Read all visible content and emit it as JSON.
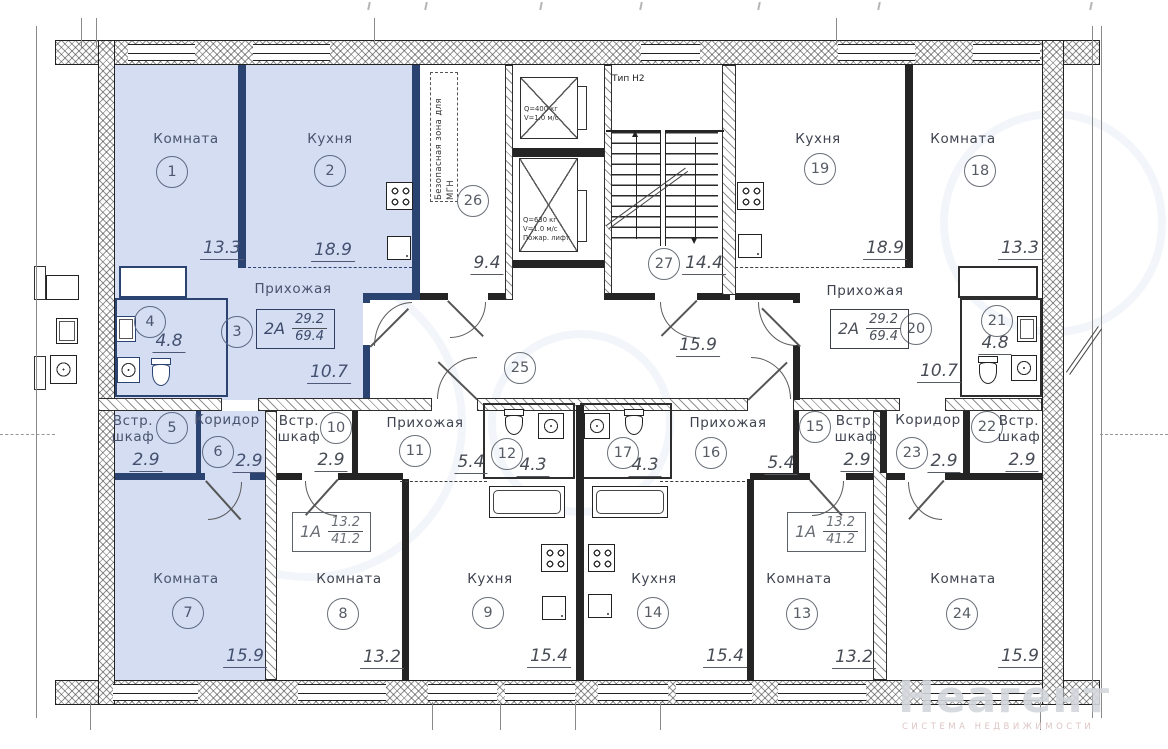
{
  "rooms": {
    "r1": {
      "name": "Комната",
      "num": "1",
      "area": "13.3"
    },
    "r2": {
      "name": "Кухня",
      "num": "2",
      "area": "18.9"
    },
    "r3": {
      "name": "Прихожая",
      "num": "3",
      "area": "10.7"
    },
    "r4": {
      "num": "4",
      "area": "4.8"
    },
    "r5": {
      "name1": "Встр.",
      "name2": "шкаф",
      "num": "5",
      "area": "2.9"
    },
    "r6": {
      "name": "Коридор",
      "num": "6",
      "area": "2.9"
    },
    "r7": {
      "name": "Комната",
      "num": "7",
      "area": "15.9"
    },
    "r8": {
      "name": "Комната",
      "num": "8",
      "area": "13.2"
    },
    "r9": {
      "name": "Кухня",
      "num": "9",
      "area": "15.4"
    },
    "r10": {
      "name1": "Встр.",
      "name2": "шкаф",
      "num": "10",
      "area": "2.9"
    },
    "r11": {
      "name": "Прихожая",
      "num": "11",
      "area": "5.4"
    },
    "r12": {
      "num": "12",
      "area": "4.3"
    },
    "r13": {
      "name": "Комната",
      "num": "13",
      "area": "13.2"
    },
    "r14": {
      "name": "Кухня",
      "num": "14",
      "area": "15.4"
    },
    "r15": {
      "name1": "Встр.",
      "name2": "шкаф",
      "num": "15",
      "area": "2.9"
    },
    "r16": {
      "name": "Прихожая",
      "num": "16",
      "area": "5.4"
    },
    "r17": {
      "num": "17",
      "area": "4.3"
    },
    "r18": {
      "name": "Комната",
      "num": "18",
      "area": "13.3"
    },
    "r19": {
      "name": "Кухня",
      "num": "19",
      "area": "18.9"
    },
    "r20": {
      "name": "Прихожая",
      "num": "20",
      "area": "10.7"
    },
    "r21": {
      "num": "21",
      "area": "4.8"
    },
    "r22": {
      "name1": "Встр.",
      "name2": "шкаф",
      "num": "22",
      "area": "2.9"
    },
    "r23": {
      "name": "Коридор",
      "num": "23",
      "area": "2.9"
    },
    "r24": {
      "name": "Комната",
      "num": "24",
      "area": "15.9"
    },
    "r25": {
      "num": "25",
      "area": "15.9"
    },
    "r26": {
      "num": "26",
      "area": "9.4"
    },
    "r27": {
      "num": "27",
      "area": "14.4"
    }
  },
  "tags": {
    "t2a_left": {
      "type": "2А",
      "living": "29.2",
      "total": "69.4"
    },
    "t2a_right": {
      "type": "2А",
      "living": "29.2",
      "total": "69.4"
    },
    "t1a_left": {
      "type": "1А",
      "living": "13.2",
      "total": "41.2"
    },
    "t1a_right": {
      "type": "1А",
      "living": "13.2",
      "total": "41.2"
    }
  },
  "core": {
    "stair_type": "Тип Н2",
    "safe_zone": "Безопасная зона для МГН",
    "lift1": {
      "l1": "Q=400 кг",
      "l2": "V=1.0 м/с"
    },
    "lift2": {
      "l1": "Q=630 кг",
      "l2": "V=1.0 м/с",
      "l3": "Пожар. лифт"
    }
  },
  "watermark": {
    "title": "Неагент",
    "subtitle": "СИСТЕМА НЕДВИЖИМОСТИ"
  },
  "colors": {
    "highlight_fill": "#d4ddf1",
    "highlight_wall": "#2b4371",
    "wall": "#242424"
  }
}
